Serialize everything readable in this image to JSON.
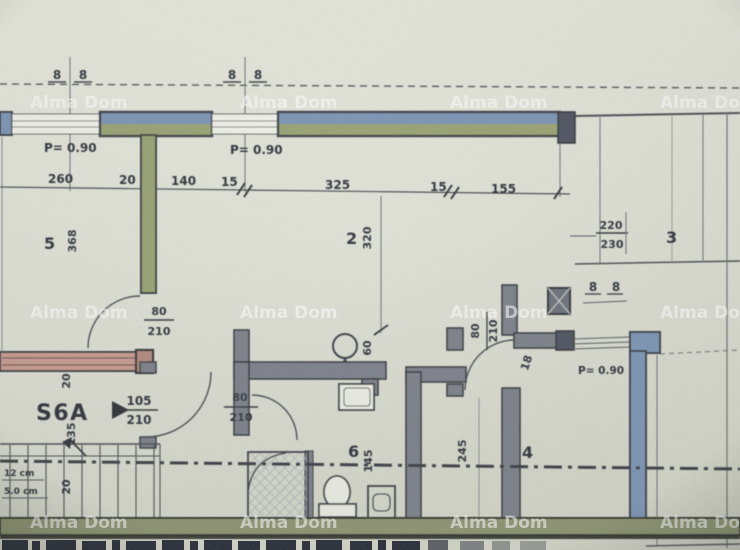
{
  "watermark": {
    "text": "Alma Dom"
  },
  "unit": {
    "label": "S6A"
  },
  "axis_markers": {
    "left": [
      "8",
      "8"
    ],
    "mid": [
      "8",
      "8"
    ],
    "right": [
      "8",
      "8"
    ]
  },
  "parapets": {
    "p1": "P= 0.90",
    "p2": "P= 0.90",
    "p3": "P= 0.90"
  },
  "dims": {
    "top": [
      "260",
      "20",
      "140",
      "15",
      "325",
      "15",
      "155"
    ],
    "room5_h": "368",
    "room2_h": "320",
    "room3_w_over": "220",
    "room3_w_under": "230",
    "hall_w": "245",
    "wc_h": "145",
    "lamp_offset": "60",
    "wall_20a": "20",
    "hall_135": "135",
    "stair_20": "20",
    "door_gap": "18",
    "stair_note1": "12 cm",
    "stair_note2": "5.0 cm"
  },
  "rooms": {
    "r5": "5",
    "r2": "2",
    "r3": "3",
    "r4": "4",
    "r6": "6"
  },
  "doors": {
    "left": {
      "w": "80",
      "h": "210"
    },
    "entry": {
      "w": "105",
      "h": "210"
    },
    "bath": {
      "w": "80",
      "h": "210"
    },
    "room4": {
      "w": "80",
      "h": "210"
    }
  },
  "colors": {
    "window_blue": "#7b95b5",
    "wall_green": "#9aa273",
    "wall_bottom_green": "#8e9472",
    "wall_pink": "#c79b8e",
    "wall_gray": "#7b8089",
    "line_dark": "#3e4147"
  }
}
